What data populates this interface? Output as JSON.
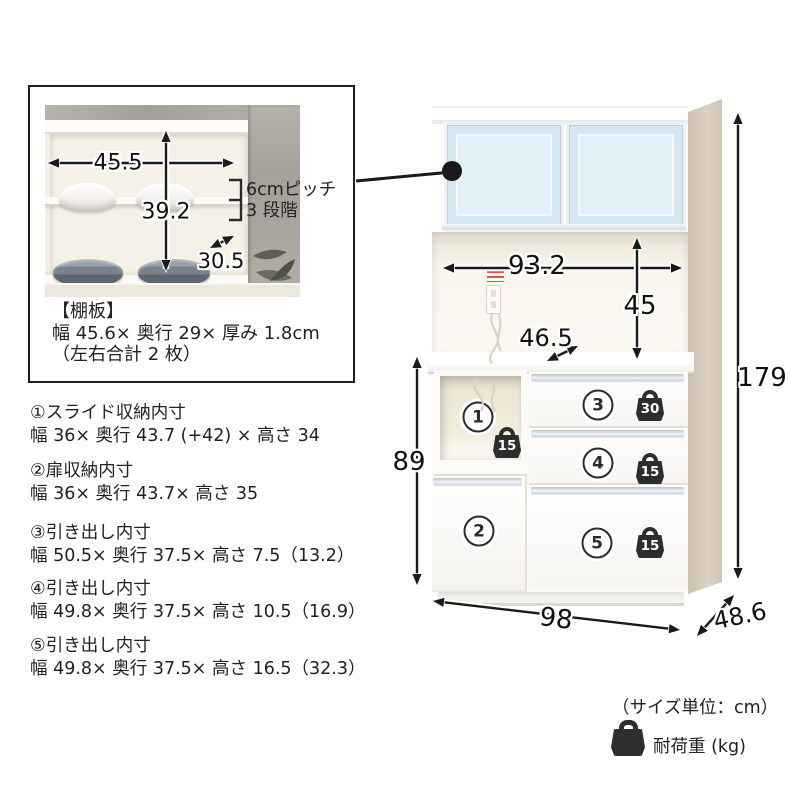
{
  "inset": {
    "dims": {
      "width": "45.5",
      "height": "39.2",
      "depth": "30.5"
    },
    "pitch_line1": "6cmピッチ",
    "pitch_line2": "3 段階",
    "note_title": "【棚板】",
    "note_line1": "幅 45.6× 奥行 29× 厚み 1.8cm",
    "note_line2": "（左右合計 2 枚）"
  },
  "specs": [
    {
      "title": "①スライド収納内寸",
      "dims": "幅 36× 奥行 43.7 (+42) × 高さ 34"
    },
    {
      "title": "②扉収納内寸",
      "dims": "幅 36× 奥行 43.7× 高さ 35"
    },
    {
      "title": "③引き出し内寸",
      "dims": "幅 50.5× 奥行 37.5× 高さ 7.5（13.2）"
    },
    {
      "title": "④引き出し内寸",
      "dims": "幅 49.8× 奥行 37.5× 高さ 10.5（16.9）"
    },
    {
      "title": "⑤引き出し内寸",
      "dims": "幅 49.8× 奥行 37.5× 高さ 16.5（32.3）"
    }
  ],
  "cabinet": {
    "dims": {
      "inner_width": "93.2",
      "inner_height": "45",
      "counter_depth": "46.5",
      "lower_height": "89",
      "total_height": "179",
      "width": "98",
      "depth": "48.6"
    },
    "sections": [
      {
        "label": "1"
      },
      {
        "label": "2"
      },
      {
        "label": "3"
      },
      {
        "label": "4"
      },
      {
        "label": "5"
      }
    ],
    "loads": {
      "slot": "15",
      "drawer3": "30",
      "drawer4": "15",
      "drawer5": "15"
    }
  },
  "footer": {
    "unit_note": "（サイズ単位：cm）",
    "load_label": "耐荷重 (kg)",
    "load_icon": "weight-bag-icon"
  },
  "colors": {
    "glass_blue": "#d5e7f1",
    "wood_side": "#d3c7b5",
    "badge_dark": "#2d2d2d",
    "arrow_black": "#1a1a1a"
  }
}
